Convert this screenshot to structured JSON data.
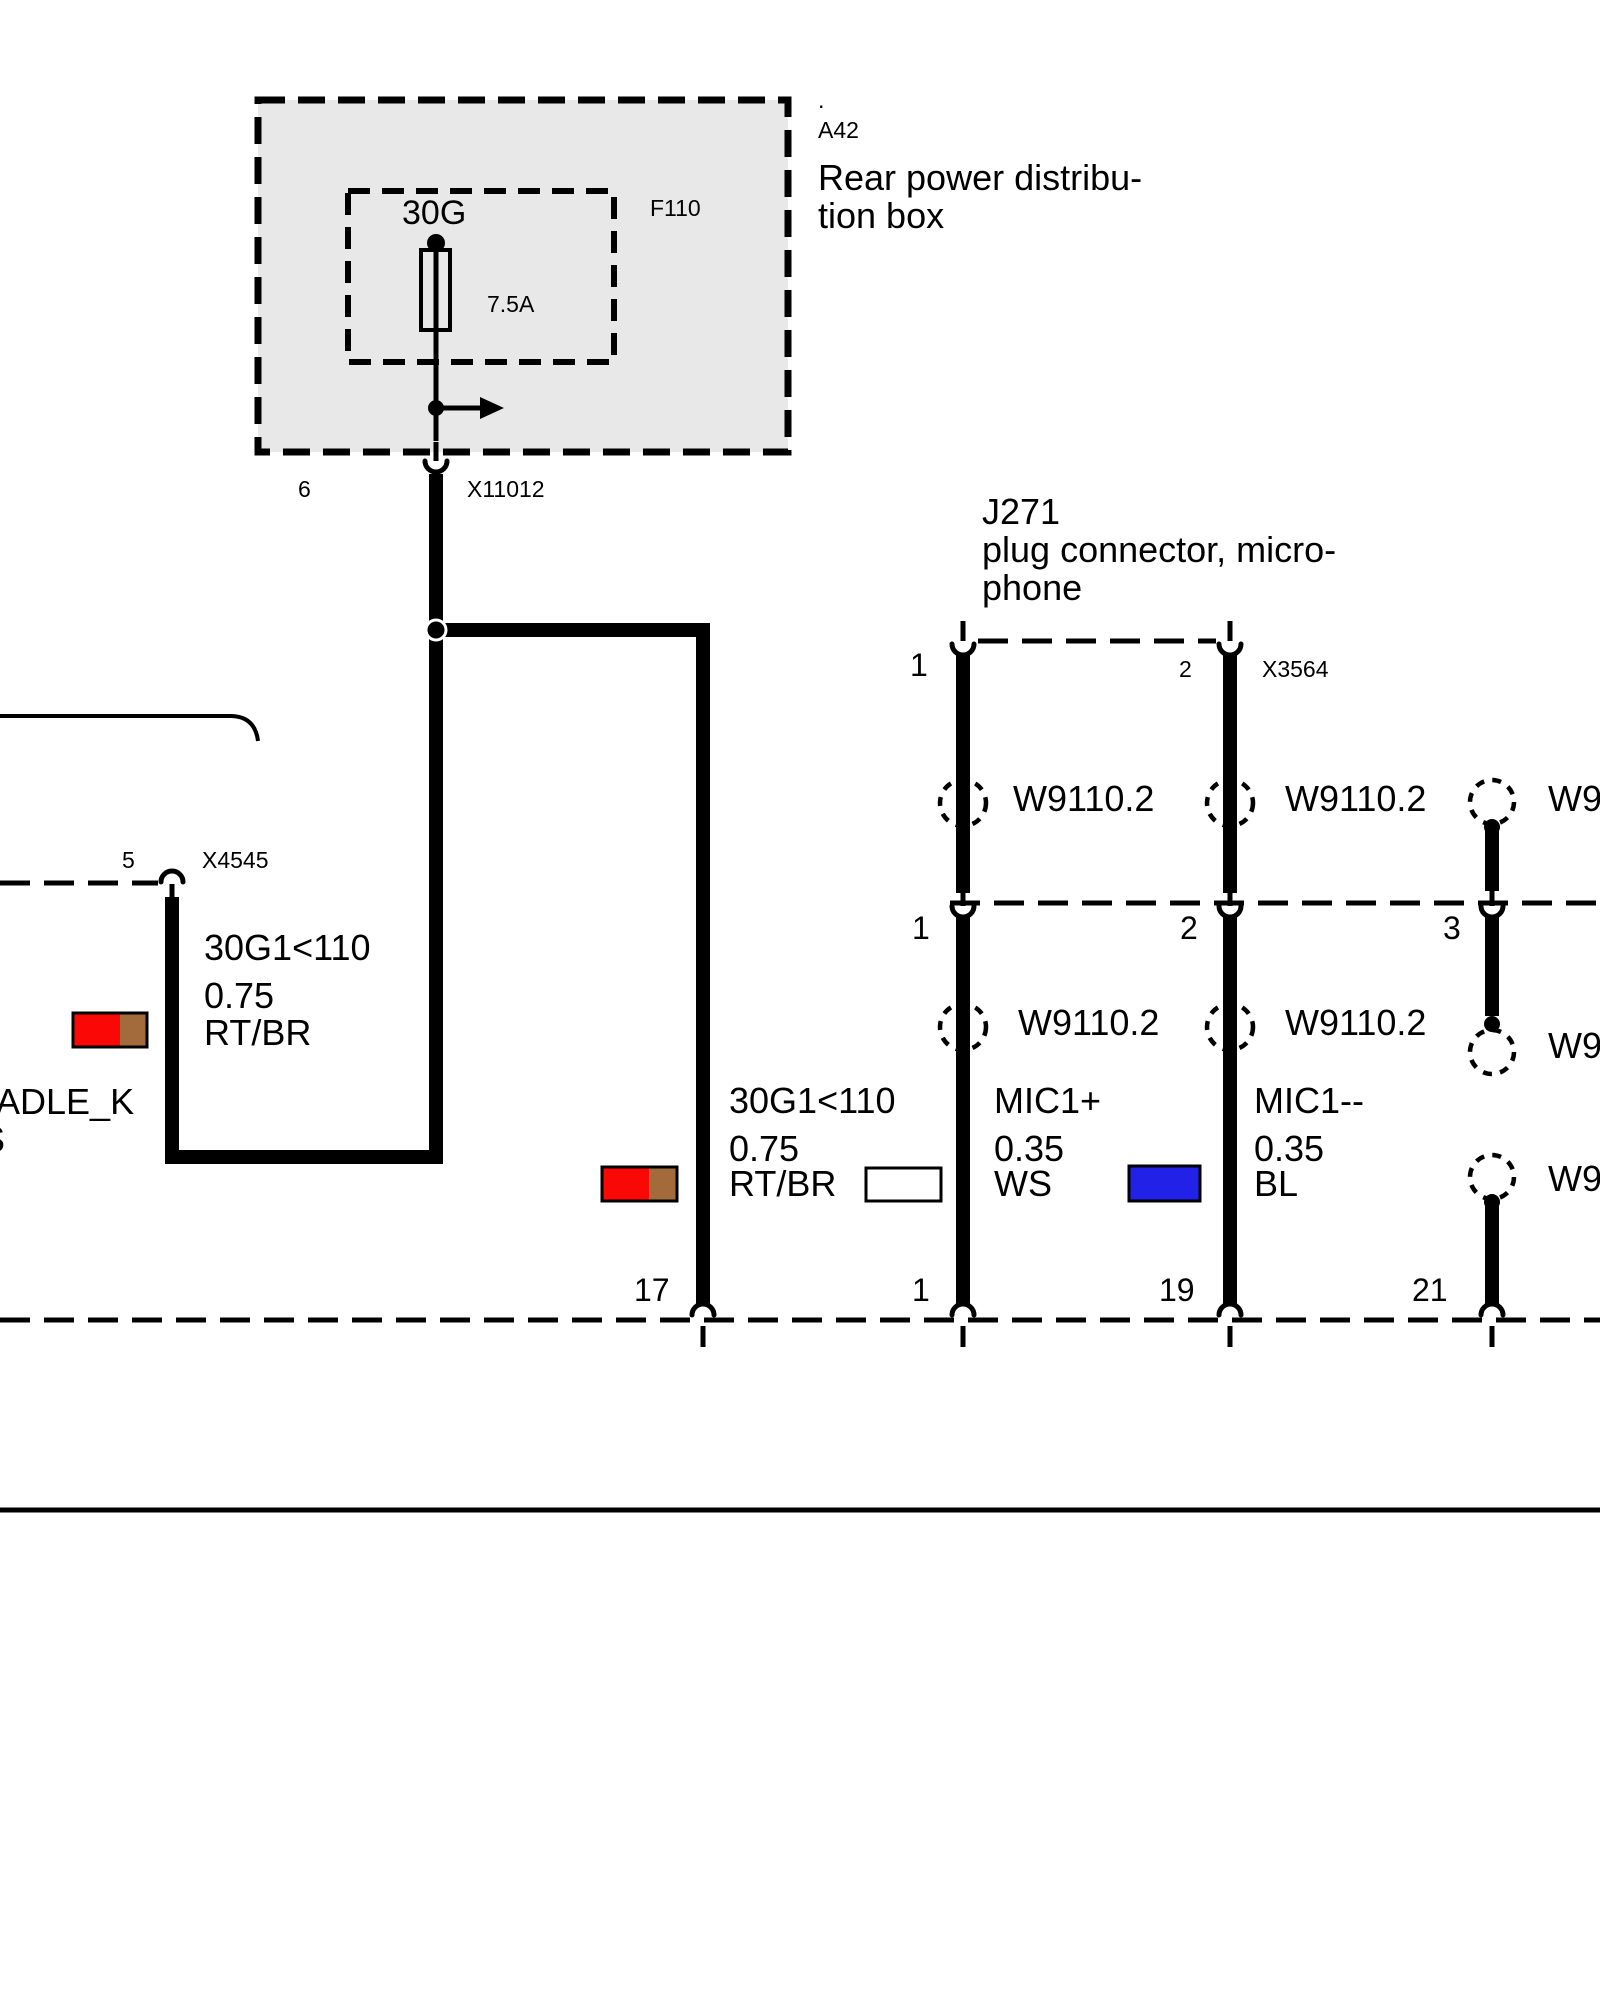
{
  "colors": {
    "red": "#F90805",
    "brown": "#A36B3C",
    "blue": "#2121E8",
    "white": "#FFFFFF",
    "box_fill": "#E8E8E8",
    "line": "#000000"
  },
  "distribution_box": {
    "dot": ".",
    "id": "A42",
    "title_line1": "Rear power distribu-",
    "title_line2": "tion box",
    "terminal": "30G",
    "fuse_id": "F110",
    "fuse_rating": "7.5A"
  },
  "connector_x11012": {
    "pin": "6",
    "id": "X11012"
  },
  "connector_x4545": {
    "pin": "5",
    "id": "X4545"
  },
  "j271": {
    "id": "J271",
    "desc_line1": "plug connector, micro-",
    "desc_line2": "phone",
    "pin1": "1",
    "pin2": "2",
    "plug_id": "X3564"
  },
  "line2_pins": {
    "pin1": "1",
    "pin2": "2",
    "pin3": "3"
  },
  "bottom_pins": {
    "pin17": "17",
    "pin1": "1",
    "pin19": "19",
    "pin21": "21"
  },
  "splice_labels": {
    "r1c1": "W9110.2",
    "r1c2": "W9110.2",
    "r1c3": "W9110.2",
    "r2c1": "W9110.2",
    "r2c2": "W9110.2",
    "r2c3": "W9110.2",
    "r3c3": "W9110.2"
  },
  "wire_labels": {
    "branch_left": {
      "circuit": "30G1<110",
      "cross_section": "0.75",
      "color_code": "RT/BR"
    },
    "branch_feed": {
      "circuit": "30G1<110",
      "cross_section": "0.75",
      "color_code": "RT/BR"
    },
    "mic_plus": {
      "circuit": "MIC1+",
      "cross_section": "0.35",
      "color_code": "WS"
    },
    "mic_minus": {
      "circuit": "MIC1--",
      "cross_section": "0.35",
      "color_code": "BL"
    }
  },
  "clipped_text": {
    "line1": "ADLE_K",
    "line2": "S"
  }
}
